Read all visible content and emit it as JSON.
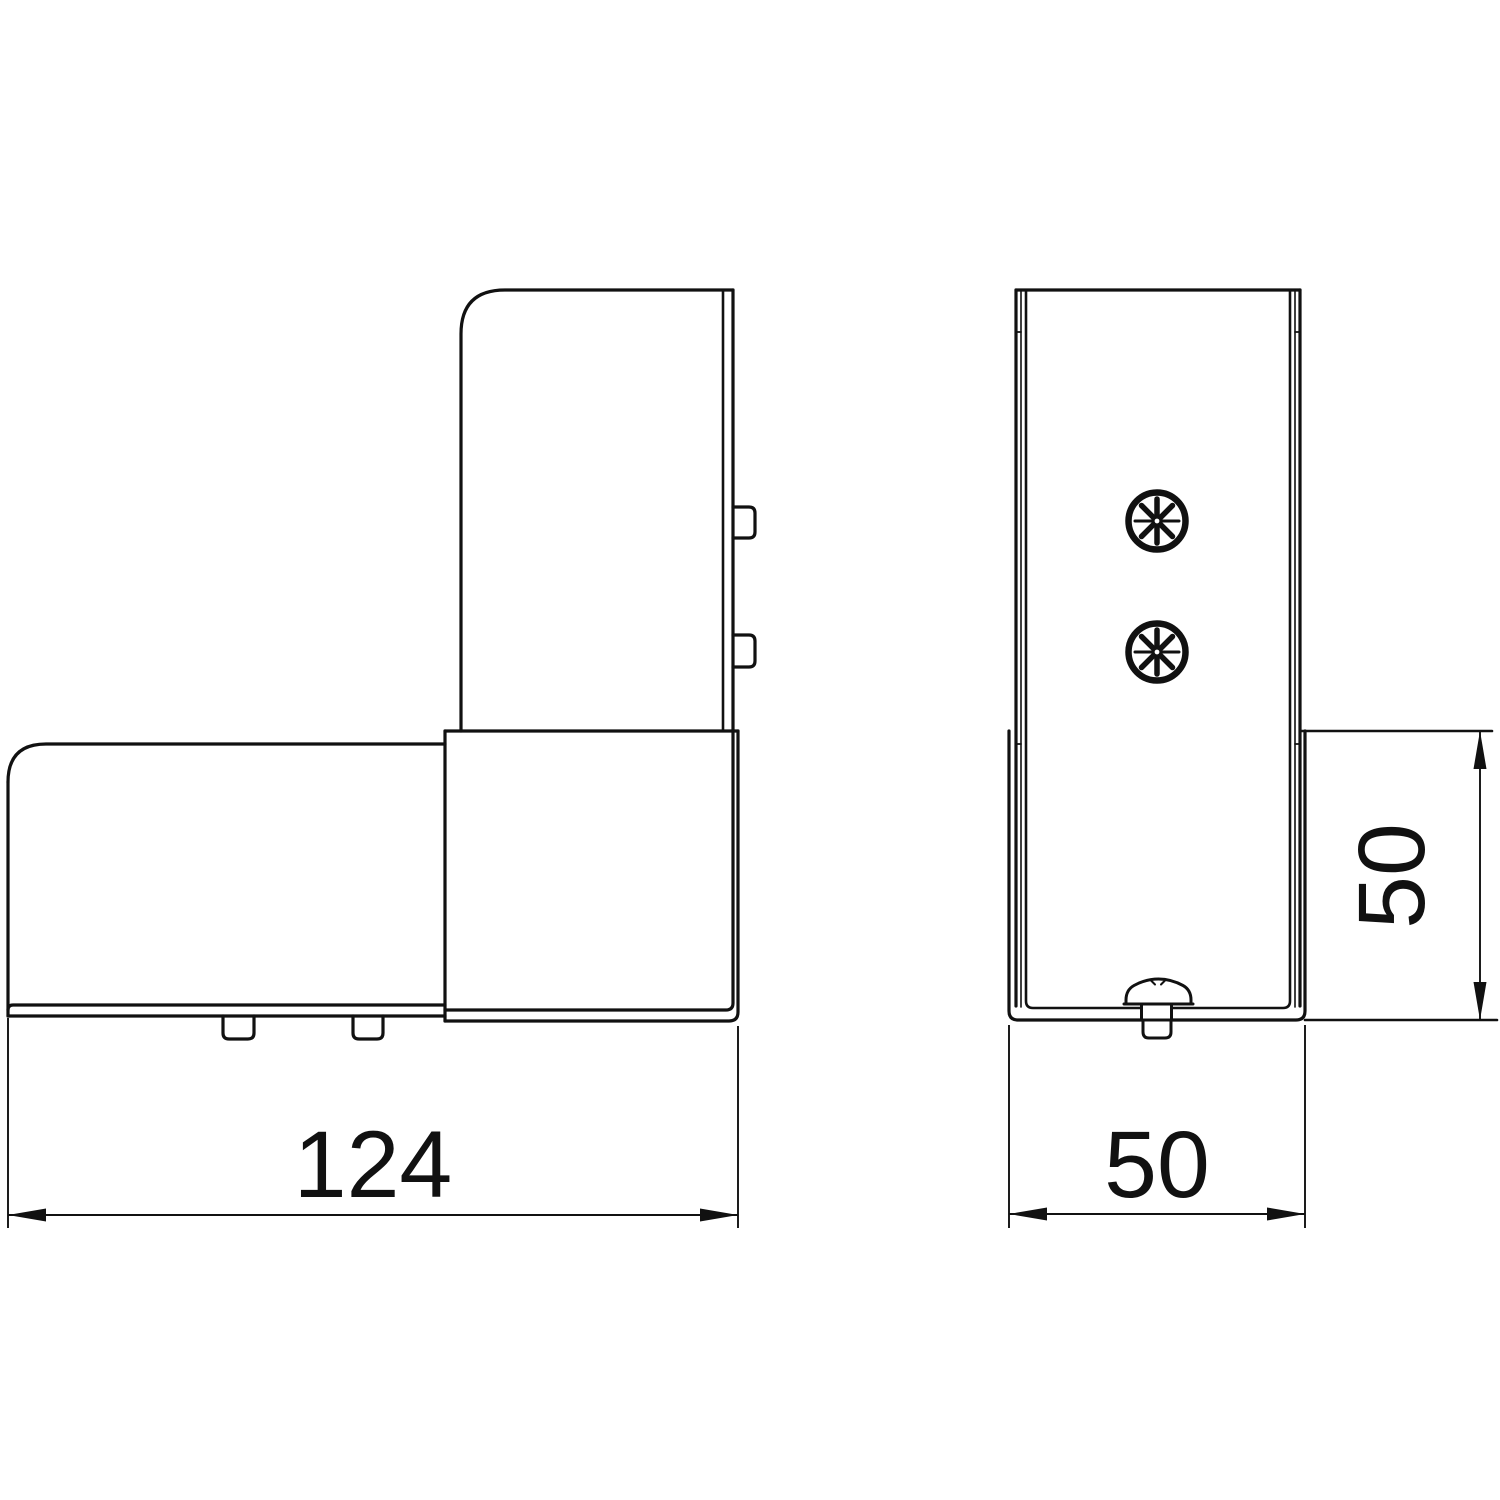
{
  "drawing": {
    "kind": "technical-dimension-drawing",
    "part": "L-shaped corner bracket, two orthographic views",
    "background_color": "#ffffff",
    "line_color": "#111111",
    "views": {
      "front": {
        "description": "L-shaped side elevation with two side tabs and two bottom tabs",
        "dim_width": {
          "value": "124",
          "orientation": "horizontal"
        }
      },
      "side": {
        "description": "channel profile with two Pozidriv screw heads and one screw in side view",
        "screw_symbol_count": 2,
        "dim_width": {
          "value": "50",
          "orientation": "horizontal"
        },
        "dim_height": {
          "value": "50",
          "orientation": "vertical"
        }
      }
    },
    "labels": {
      "front_width": "124",
      "side_width": "50",
      "side_height": "50"
    }
  }
}
